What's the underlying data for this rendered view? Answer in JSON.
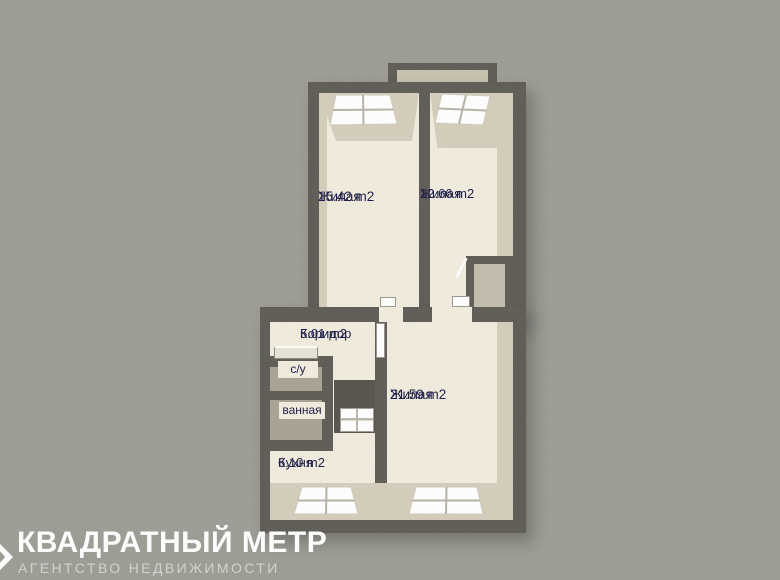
{
  "palette": {
    "background": "#9c9c95",
    "wall": "#5e5b55",
    "floor": "#f1ecdd",
    "inner_wall": "#d5cdbb",
    "small_room_floor": "#a9a293",
    "balcony_floor": "#c9c1af",
    "niche_floor": "#c3bcab",
    "window": "#ffffff",
    "label_text": "#191945",
    "watermark_title_color": "#ffffff",
    "watermark_subtitle_color": "#d3d3d0"
  },
  "rooms": {
    "living1": {
      "name": "Жилая",
      "area": "15.42 m2"
    },
    "living2": {
      "name": "Жилая",
      "area": "12.66 m2"
    },
    "corridor": {
      "name": "Коридор",
      "area": "5.01 m2"
    },
    "wc": {
      "name": "с/у"
    },
    "bath": {
      "name": "ванная"
    },
    "living3": {
      "name": "Жилая",
      "area": "21.59 m2"
    },
    "kitchen": {
      "name": "Кухня",
      "area": "6.10 m2"
    }
  },
  "watermark": {
    "title": "КВАДРАТНЫЙ МЕТР",
    "subtitle": "АГЕНТСТВО НЕДВИЖИМОСТИ"
  }
}
